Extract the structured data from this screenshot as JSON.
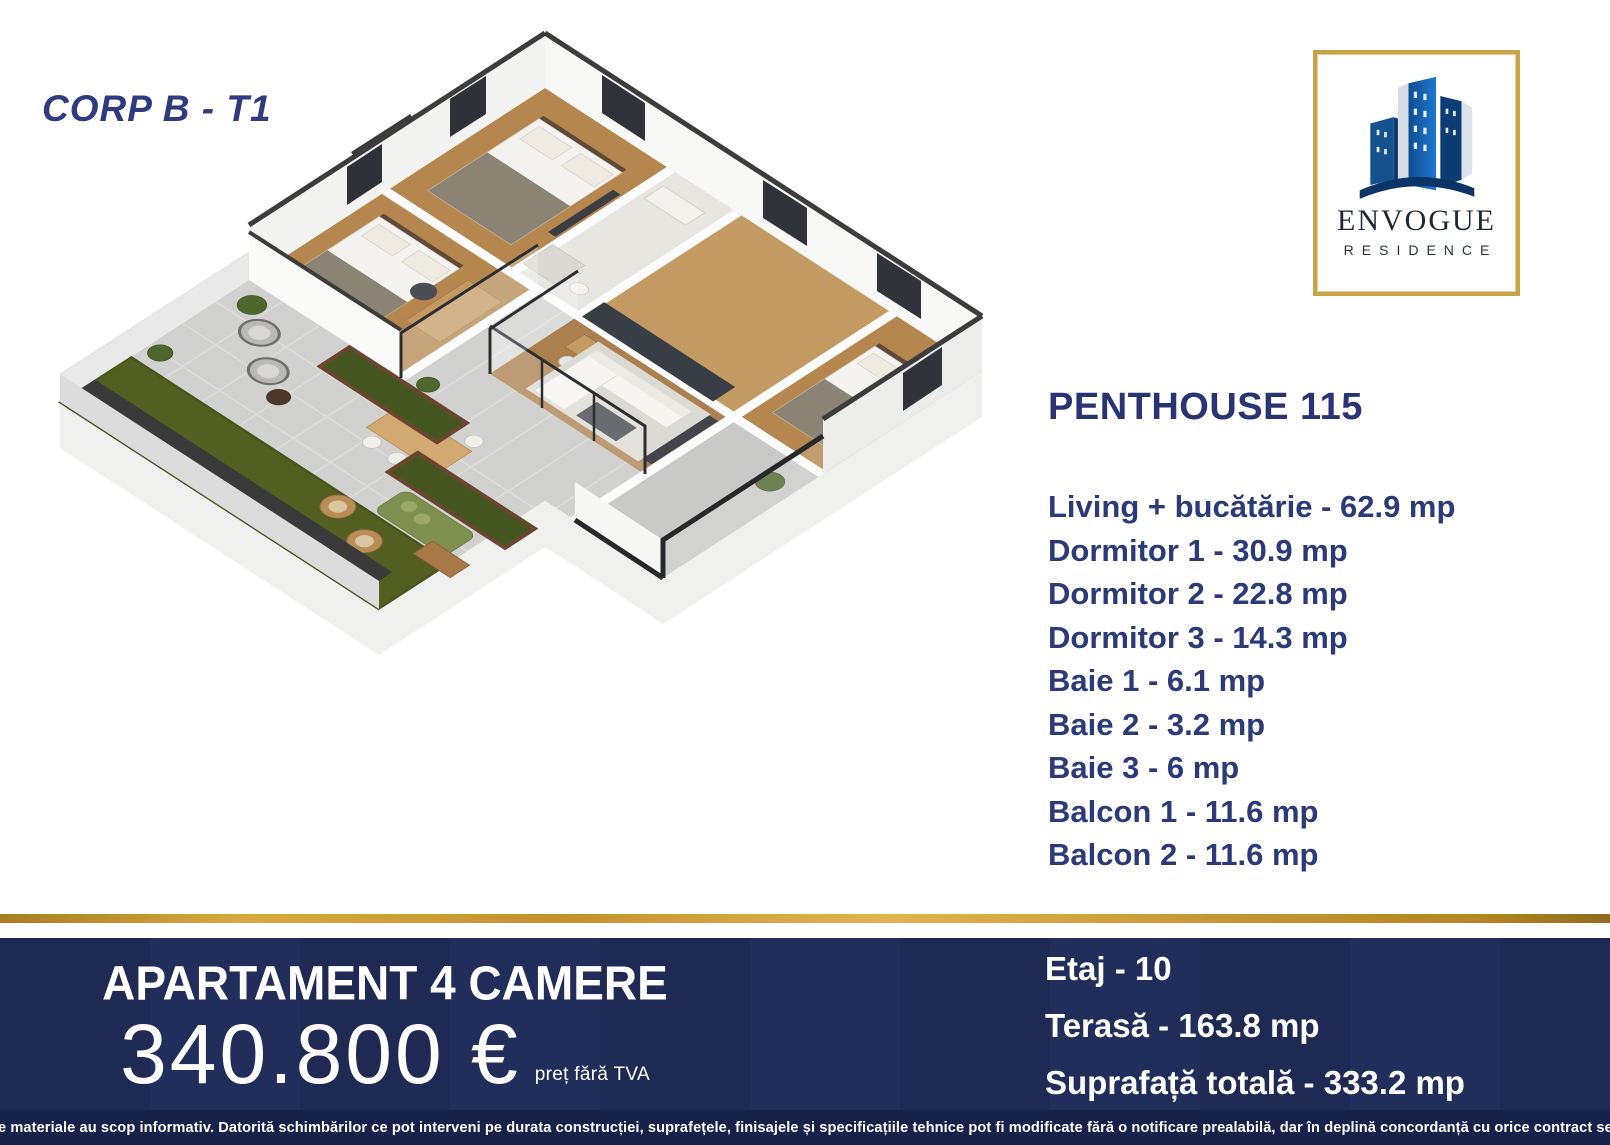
{
  "header": {
    "corp_label": "CORP B - T1"
  },
  "logo": {
    "line1": "ENVOGUE",
    "line2": "RESIDENCE",
    "border_gold": "#c9a34a",
    "building_blue": "#0f4c92"
  },
  "unit": {
    "title": "PENTHOUSE 115",
    "rooms": [
      "Living + bucătărie - 62.9 mp",
      "Dormitor 1 - 30.9 mp",
      "Dormitor 2 - 22.8 mp",
      "Dormitor 3 - 14.3 mp",
      "Baie 1 - 6.1 mp",
      "Baie 2 - 3.2 mp",
      "Baie 3 - 6 mp",
      "Balcon 1 - 11.6 mp",
      "Balcon 2 - 11.6 mp"
    ]
  },
  "offer": {
    "apartment_type": "APARTAMENT 4 CAMERE",
    "price": "340.800 €",
    "price_note": "preț fără TVA"
  },
  "details": {
    "floor": "Etaj - 10",
    "terrace": "Terasă - 163.8 mp",
    "total_area": "Suprafață totală - 333.2 mp"
  },
  "disclaimer": "Aceste materiale au scop informativ. Datorită schimbărilor ce pot interveni pe durata construcției, suprafețele, finisajele și specificațiile tehnice pot fi modificate fără o notificare prealabilă, dar în deplină concordanță cu orice contract semnat.",
  "colors": {
    "navy_text": "#2b3a78",
    "banner_bg": "#1e2a54",
    "disclaimer_bg": "#18214a",
    "gold": "#c9a34a",
    "grass": "#535f20",
    "terrace_paving": "#d1d1cf",
    "wood_floor": "#b5874f"
  }
}
